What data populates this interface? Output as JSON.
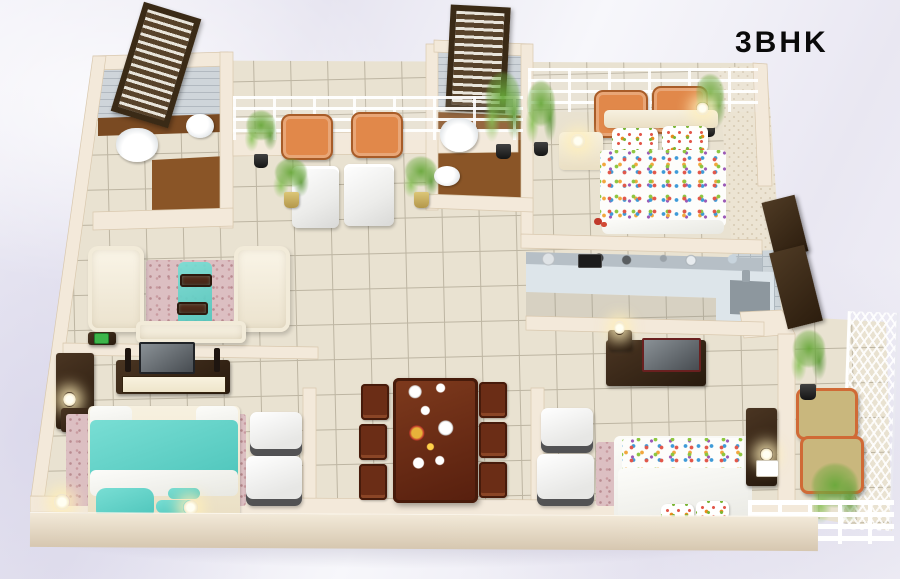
{
  "title": "3BHK",
  "scene": {
    "type": "isometric-3d-floor-plan",
    "rooms": [
      "bathroom-1",
      "balcony-lounge",
      "bathroom-2",
      "master-bedroom",
      "kitchen",
      "living-room",
      "dining-area",
      "teal-bedroom",
      "white-bedroom",
      "right-balcony"
    ]
  },
  "palette": {
    "ink": "#0a0a0a",
    "wall": "#f3e9da",
    "wall-edge": "#d9c8ae",
    "tile": "#e9e2d1",
    "grout": "#bdb5a2",
    "wood": "#8a5527",
    "ledge": "#7a4a22",
    "teal": "#4cc4ba",
    "pink": "#dcbfc2",
    "orange": "#e1884a",
    "khaki": "#c9b77d",
    "counter": "#dde5ea",
    "backsplash": "#b6bfc6",
    "sink": "#8d979e",
    "green": "#68a83a"
  }
}
